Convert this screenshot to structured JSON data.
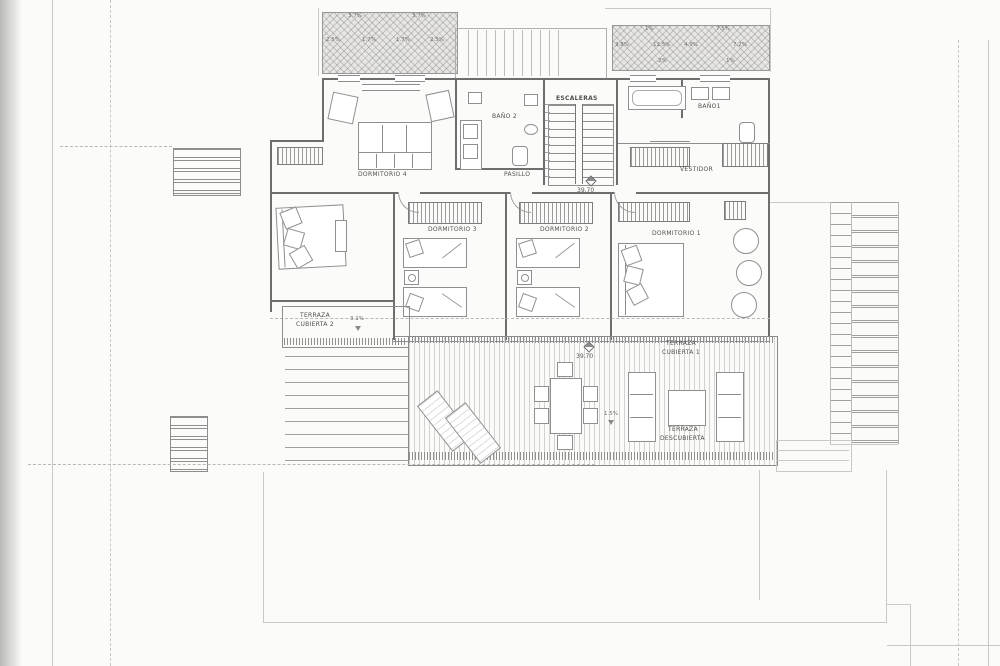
{
  "drawing": {
    "rooms": {
      "dormitorio4": "DORMITORIO 4",
      "bano2": "BAÑO 2",
      "escaleras": "ESCALERAS",
      "pasillo": "PASILLO",
      "bano1": "BAÑO1",
      "vestidor": "VESTIDOR",
      "dormitorio3": "DORMITORIO 3",
      "dormitorio2": "DORMITORIO 2",
      "dormitorio1": "DORMITORIO 1",
      "terraza_cubierta2_l1": "TERRAZA",
      "terraza_cubierta2_l2": "CUBIERTA 2",
      "terraza_cubierta1_l1": "TERRAZA",
      "terraza_cubierta1_l2": "CUBIERTA 1",
      "terraza_descubierta_l1": "TERRAZA",
      "terraza_descubierta_l2": "DESCUBIERTA"
    },
    "levels": {
      "pasillo": "39.70",
      "terraza": "39.70"
    },
    "slopes": {
      "roof_left_a": "3.7%",
      "roof_left_b": "3.7%",
      "roof_left_c": "2.5%",
      "roof_left_d": "1.7%",
      "roof_left_e": "1.7%",
      "roof_left_f": "2.5%",
      "roof_right_a": "1%",
      "roof_right_b": "7.5%",
      "roof_right_c": "3.8%",
      "roof_right_d": "12.5%",
      "roof_right_e": "4.9%",
      "roof_right_f": "7.2%",
      "roof_right_g": "2%",
      "roof_right_h": "1%",
      "terraza_cubierta2": "3.1%",
      "terraza": "1.5%"
    }
  }
}
